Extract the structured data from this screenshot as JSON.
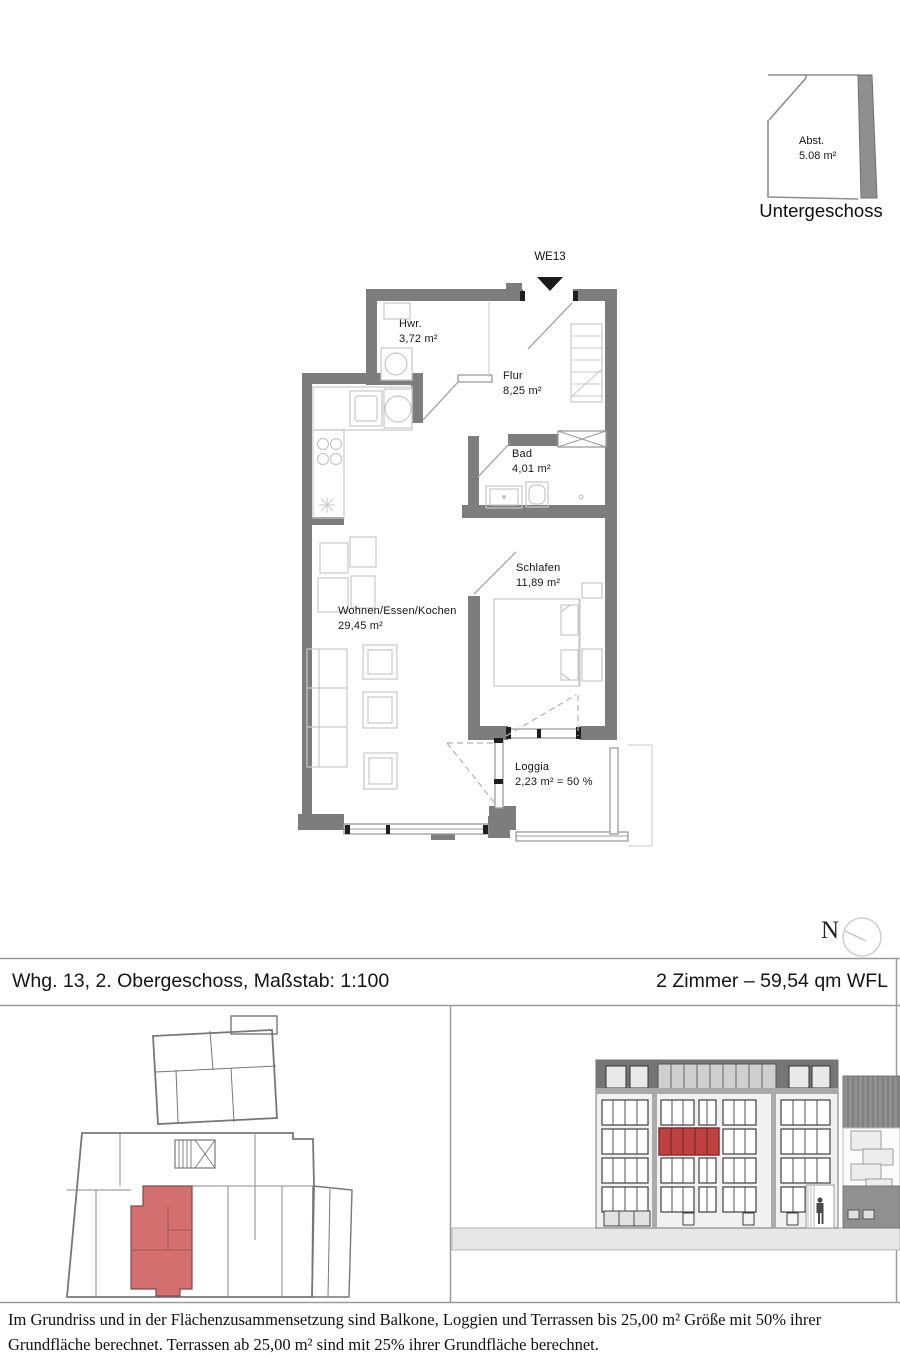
{
  "basement": {
    "room_label": "Abst.",
    "room_area": "5.08 m²",
    "caption": "Untergeschoss"
  },
  "plan": {
    "unit_marker": "WE13",
    "rooms": {
      "hwr": {
        "name": "Hwr.",
        "area": "3,72 m²"
      },
      "flur": {
        "name": "Flur",
        "area": "8,25 m²"
      },
      "bad": {
        "name": "Bad",
        "area": "4,01 m²"
      },
      "schlafen": {
        "name": "Schlafen",
        "area": "11,89 m²"
      },
      "wohnen": {
        "name": "Wohnen/Essen/Kochen",
        "area": "29,45 m²"
      },
      "loggia": {
        "name": "Loggia",
        "area": "2,23 m² = 50 %"
      }
    }
  },
  "compass": {
    "north": "N"
  },
  "titlebar": {
    "left": "Whg. 13, 2. Obergeschoss, Maßstab: 1:100",
    "right": "2 Zimmer – 59,54 qm WFL"
  },
  "disclaimer": {
    "text": "Im Grundriss und in der Flächenzusammensetzung sind Balkone, Loggien und Terrassen bis 25,00 m² Größe mit 50% ihrer Grundfläche berechnet. Terrassen ab 25,00 m² sind mit 25% ihrer Grundfläche berechnet."
  },
  "colors": {
    "wall_gray": "#7d7d7d",
    "thin_wall": "#9b9b9b",
    "furniture_gray": "#c7c7c7",
    "keyplan_highlight": "#d46f6f",
    "elevation_highlight": "#bf4040",
    "ground_gray": "#e7e7e7"
  }
}
